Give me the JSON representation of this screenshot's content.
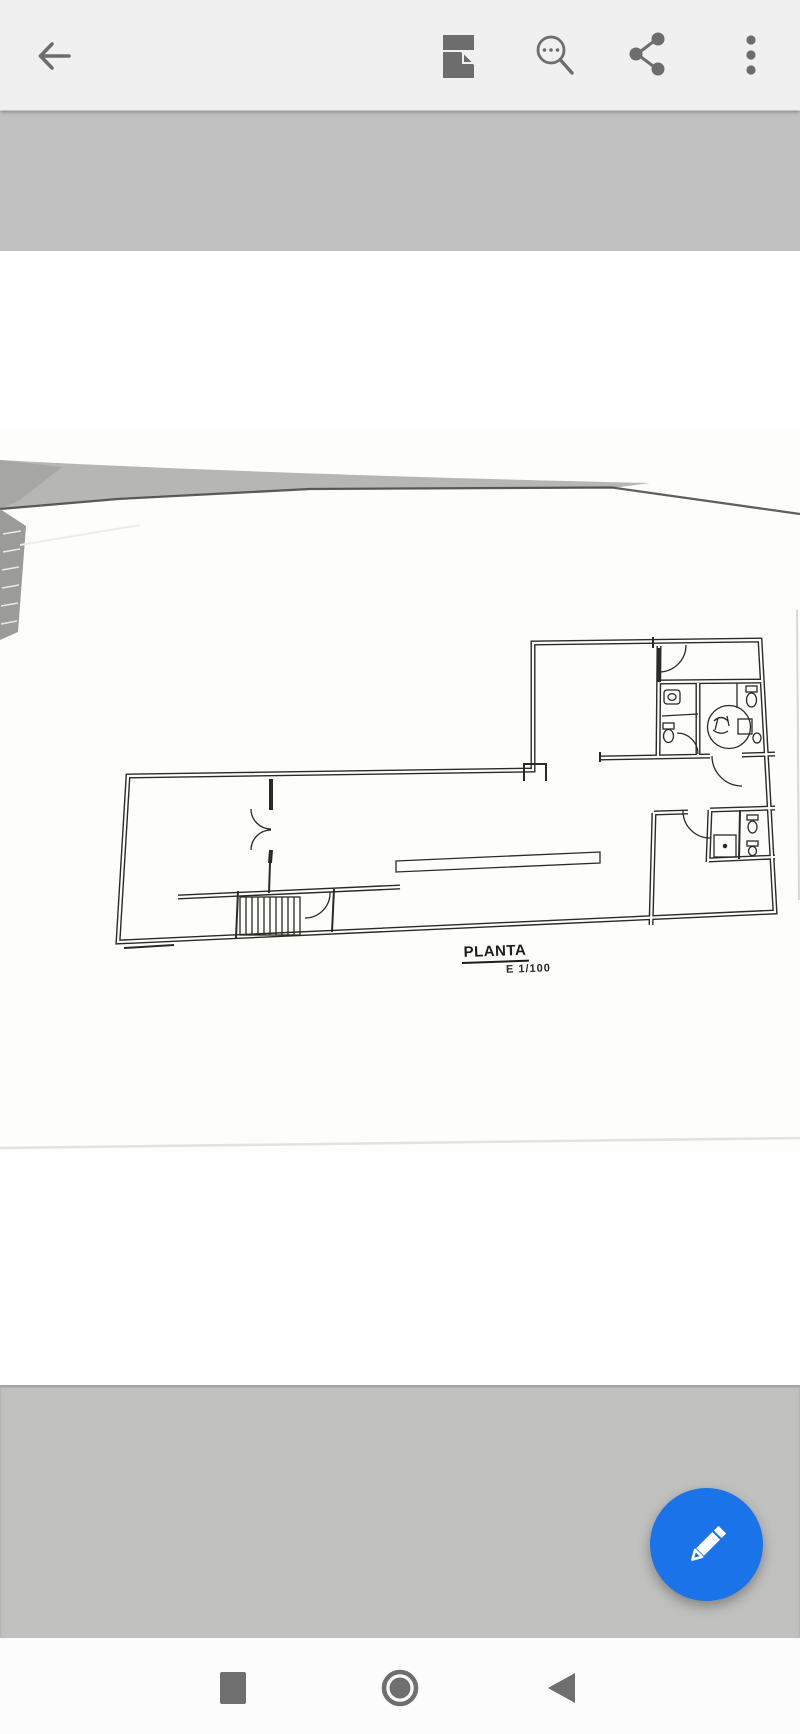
{
  "app": {
    "type": "image-viewer",
    "toolbar": {
      "background_color": "#f1f0f0",
      "icon_color": "#6d6d6d",
      "icons": [
        {
          "name": "back-arrow-icon"
        },
        {
          "name": "document-page-icon"
        },
        {
          "name": "search-magnifier-icon"
        },
        {
          "name": "share-icon"
        },
        {
          "name": "overflow-menu-icon"
        }
      ]
    },
    "fab": {
      "color": "#1a73e8",
      "icon": "pencil-edit-icon"
    },
    "navbar": {
      "background_color": "#fcfcfc",
      "icon_color": "#6f6f6f",
      "buttons": [
        {
          "name": "recents",
          "glyph": "square"
        },
        {
          "name": "home",
          "glyph": "ring-circle"
        },
        {
          "name": "back",
          "glyph": "left-triangle"
        }
      ]
    }
  },
  "viewer": {
    "letterbox_color": "#c0c0bf",
    "photo": {
      "paper_color": "#fdfdfa",
      "content": "scanned architectural floor plan drawing",
      "plan": {
        "title": "PLANTA",
        "scale": "E 1/100",
        "line_color": "#2b2a24"
      }
    }
  }
}
